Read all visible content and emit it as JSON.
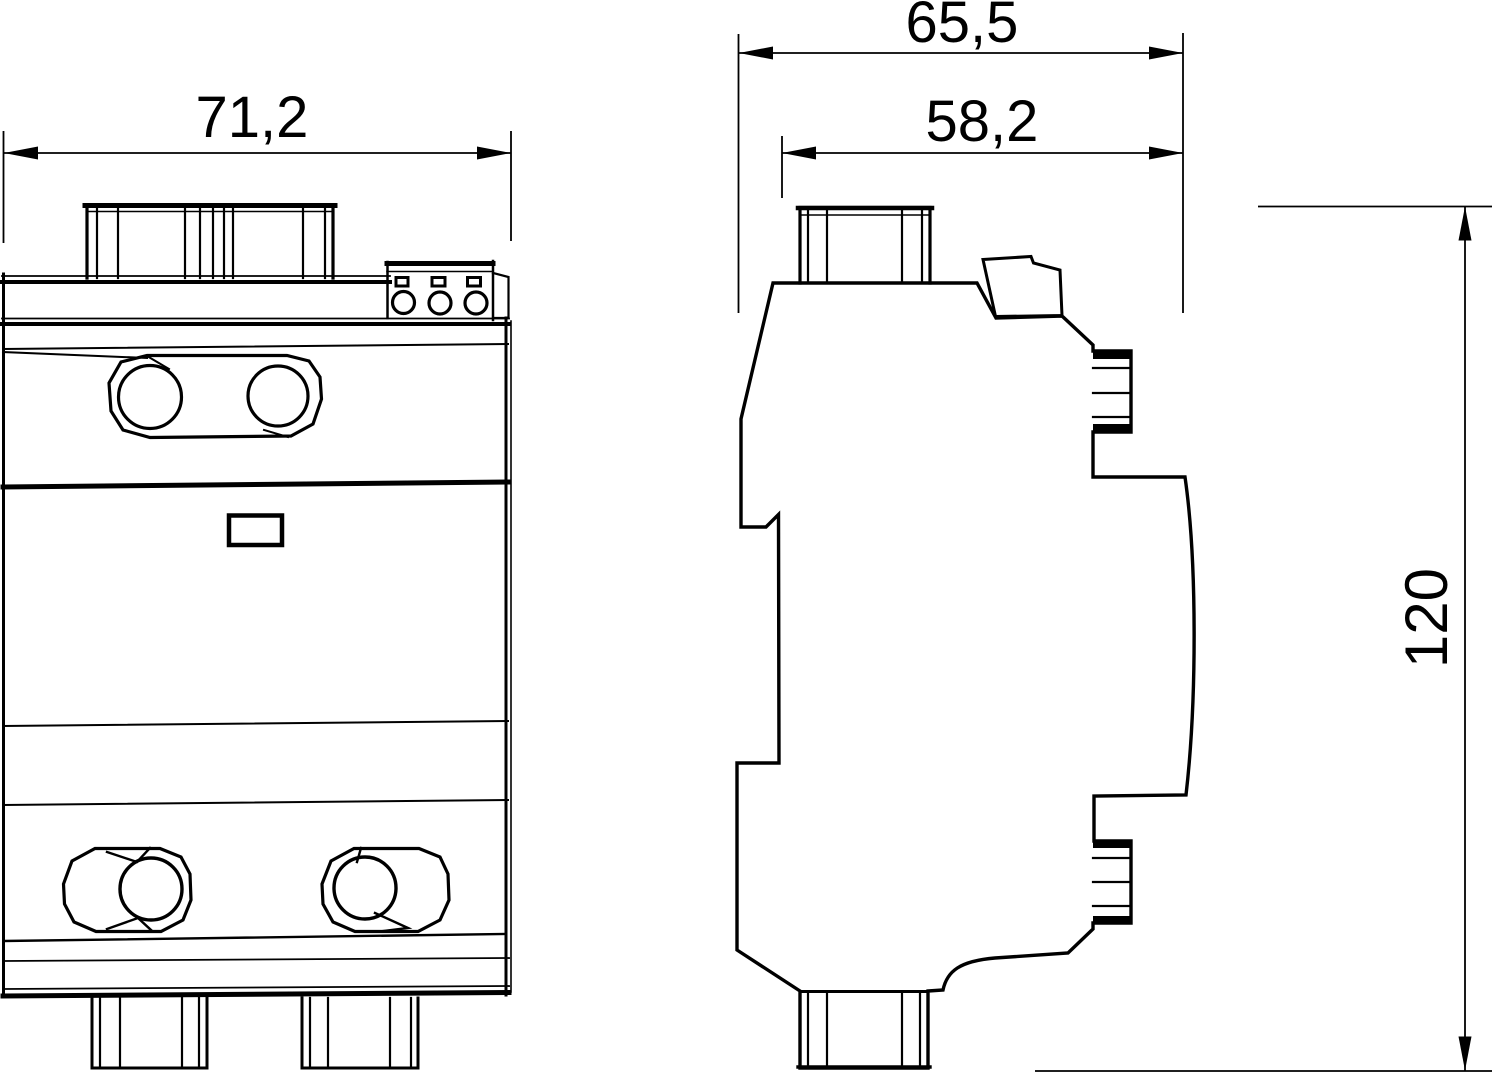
{
  "page": {
    "background": "#ffffff",
    "line_color": "#000000"
  },
  "drawing": {
    "views": [
      {
        "id": "front",
        "label": "front-view-of-device"
      },
      {
        "id": "side",
        "label": "side-view-of-device"
      }
    ],
    "dimensions": [
      {
        "id": "front-width",
        "value": "71,2"
      },
      {
        "id": "side-depth-total",
        "value": "65,5"
      },
      {
        "id": "side-depth-upper",
        "value": "58,2"
      },
      {
        "id": "side-height",
        "value": "120"
      }
    ]
  }
}
